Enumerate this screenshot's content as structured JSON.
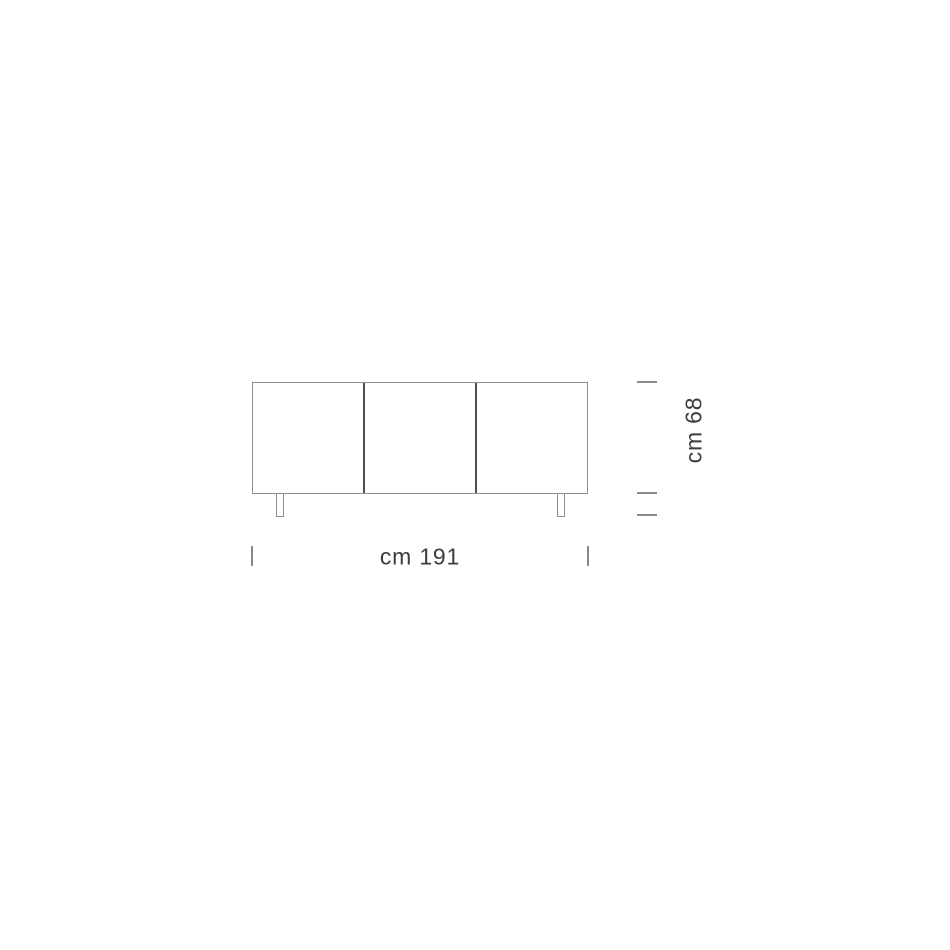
{
  "diagram": {
    "type": "furniture-dimension-drawing",
    "subject": "sideboard-front-elevation",
    "door_count": 3,
    "leg_count": 2,
    "width_label": "cm 191",
    "height_label": "cm 68",
    "colors": {
      "background": "#ffffff",
      "outline": "#8f8f8f",
      "divider": "#4d4d4d",
      "tick": "#8a8a8a",
      "text": "#3d3d3d"
    }
  }
}
